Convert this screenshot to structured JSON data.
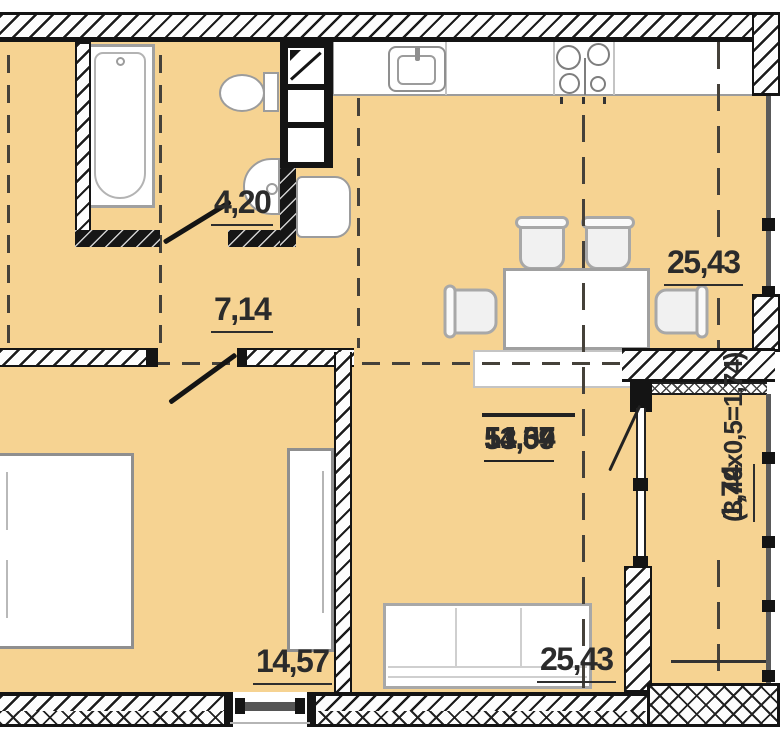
{
  "plan_title": "apartment floor plan",
  "colors": {
    "floor": "#f6d392",
    "wall": "#141414",
    "fixture_outline": "#9c9c9c",
    "zone_dash": "#45413a",
    "label_text": "#2b2b2b"
  },
  "rooms": {
    "bathroom": {
      "area": "4,20"
    },
    "hall": {
      "area": "7,14"
    },
    "kitchen_dining": {
      "area": "25,43"
    },
    "living": {
      "area": "25,43"
    },
    "bedroom": {
      "area": "14,57"
    },
    "balcony": {
      "area": "1,74",
      "formula": "(3,49x0,5=1,74)"
    }
  },
  "summary": {
    "rows": [
      "14,57",
      "51,34",
      "53,09"
    ]
  }
}
